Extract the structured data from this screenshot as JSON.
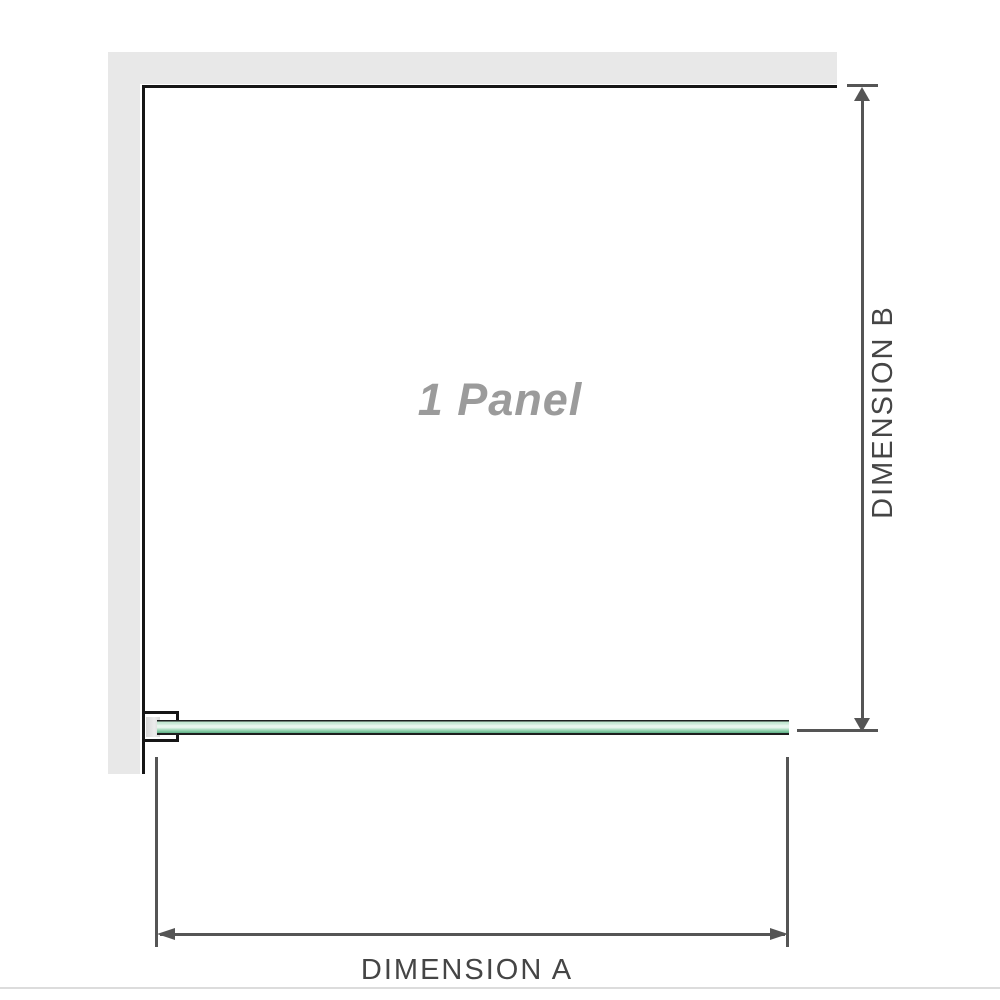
{
  "diagram": {
    "panel_label": "1 Panel",
    "dimension_a_label": "DIMENSION A",
    "dimension_b_label": "DIMENSION B"
  },
  "colors": {
    "wall": "#e8e8e8",
    "wall_edge": "#161616",
    "dimension": "#555555",
    "dimension_text": "#454545",
    "panel_label": "#9b9b9b",
    "bracket_fill": "#d8d8d8",
    "glass_light": "#e9f6ee",
    "glass_mid": "#bce4cc",
    "glass_dark": "#60ad86",
    "baseline": "#dcdcdc",
    "canvas_bg": "#ffffff"
  }
}
